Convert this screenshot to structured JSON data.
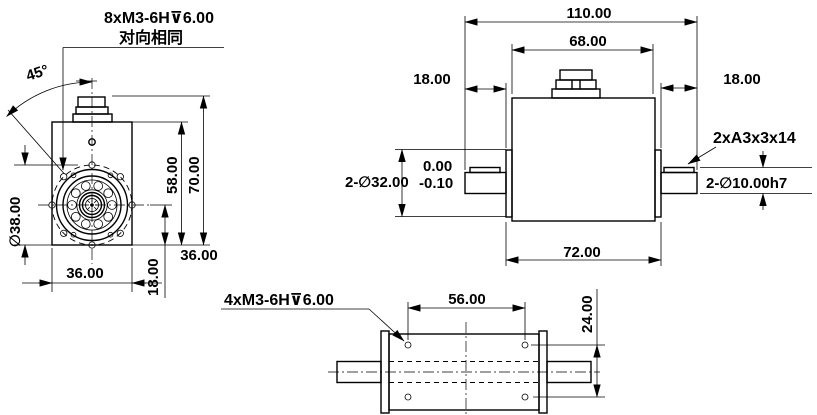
{
  "drawing": {
    "title": "torque sensor dimension drawing",
    "colors": {
      "line": "#000000",
      "background": "#ffffff"
    },
    "front_view": {
      "label_thread": "8xM3-6H⊽6.00",
      "label_thread_note": "对向相同",
      "dim_angle": "45°",
      "dim_bolt_circle": "∅38.00",
      "dim_body_height": "58.00",
      "dim_total_height": "70.00",
      "dim_square_right": "36.00",
      "dim_center_offset": "18.00",
      "dim_width_bottom": "36.00"
    },
    "side_view": {
      "dim_total_length": "110.00",
      "dim_body_top": "68.00",
      "dim_shaft_left": "18.00",
      "dim_shaft_right": "18.00",
      "label_key": "2xA3x3x14",
      "dim_boss_dia": "2-∅32.00",
      "tol_upper": "0.00",
      "tol_lower": "-0.10",
      "dim_shaft_dia": "2-∅10.00h7",
      "dim_body_bottom": "72.00"
    },
    "bottom_view": {
      "label_thread": "4xM3-6H⊽6.00",
      "dim_hole_spacing_h": "56.00",
      "dim_hole_spacing_v": "24.00"
    }
  }
}
